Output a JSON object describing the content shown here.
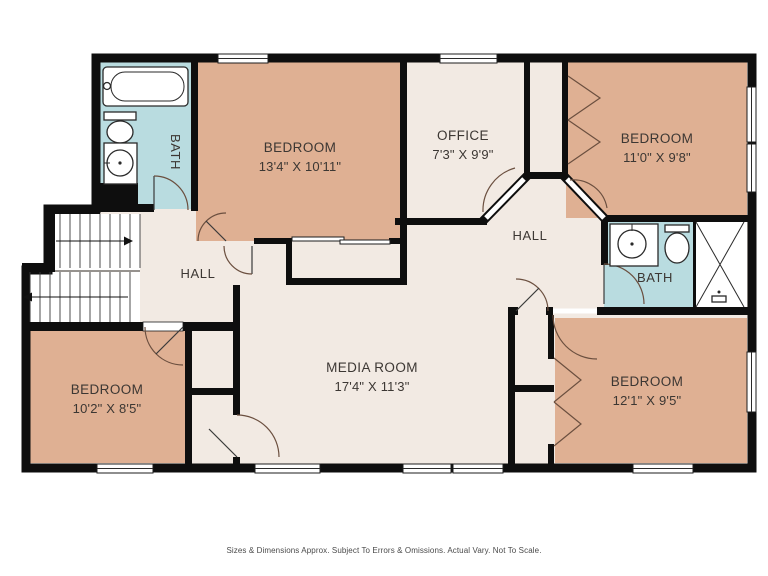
{
  "plan": {
    "rooms": [
      {
        "name": "BEDROOM",
        "dims": "13'4\" X 10'11\""
      },
      {
        "name": "OFFICE",
        "dims": "7'3\" X 9'9\""
      },
      {
        "name": "BEDROOM",
        "dims": "11'0\" X 9'8\""
      },
      {
        "name": "BEDROOM",
        "dims": "10'2\" X 8'5\""
      },
      {
        "name": "BEDROOM",
        "dims": "12'1\" X 9'5\""
      },
      {
        "name": "MEDIA ROOM",
        "dims": "17'4\" X 11'3\""
      }
    ],
    "labels": {
      "hall_left": "HALL",
      "hall_right": "HALL",
      "bath_top_left": "BATH",
      "bath_right": "BATH"
    },
    "disclaimer": "Sizes & Dimensions Approx. Subject To Errors & Omissions. Actual Vary. Not To Scale.",
    "colors": {
      "wall": "#0e0e0e",
      "bedroom_tan": "#dfb093",
      "floor_cream": "#f2eae3",
      "bath_blue": "#b9dce0",
      "white": "#ffffff"
    }
  }
}
